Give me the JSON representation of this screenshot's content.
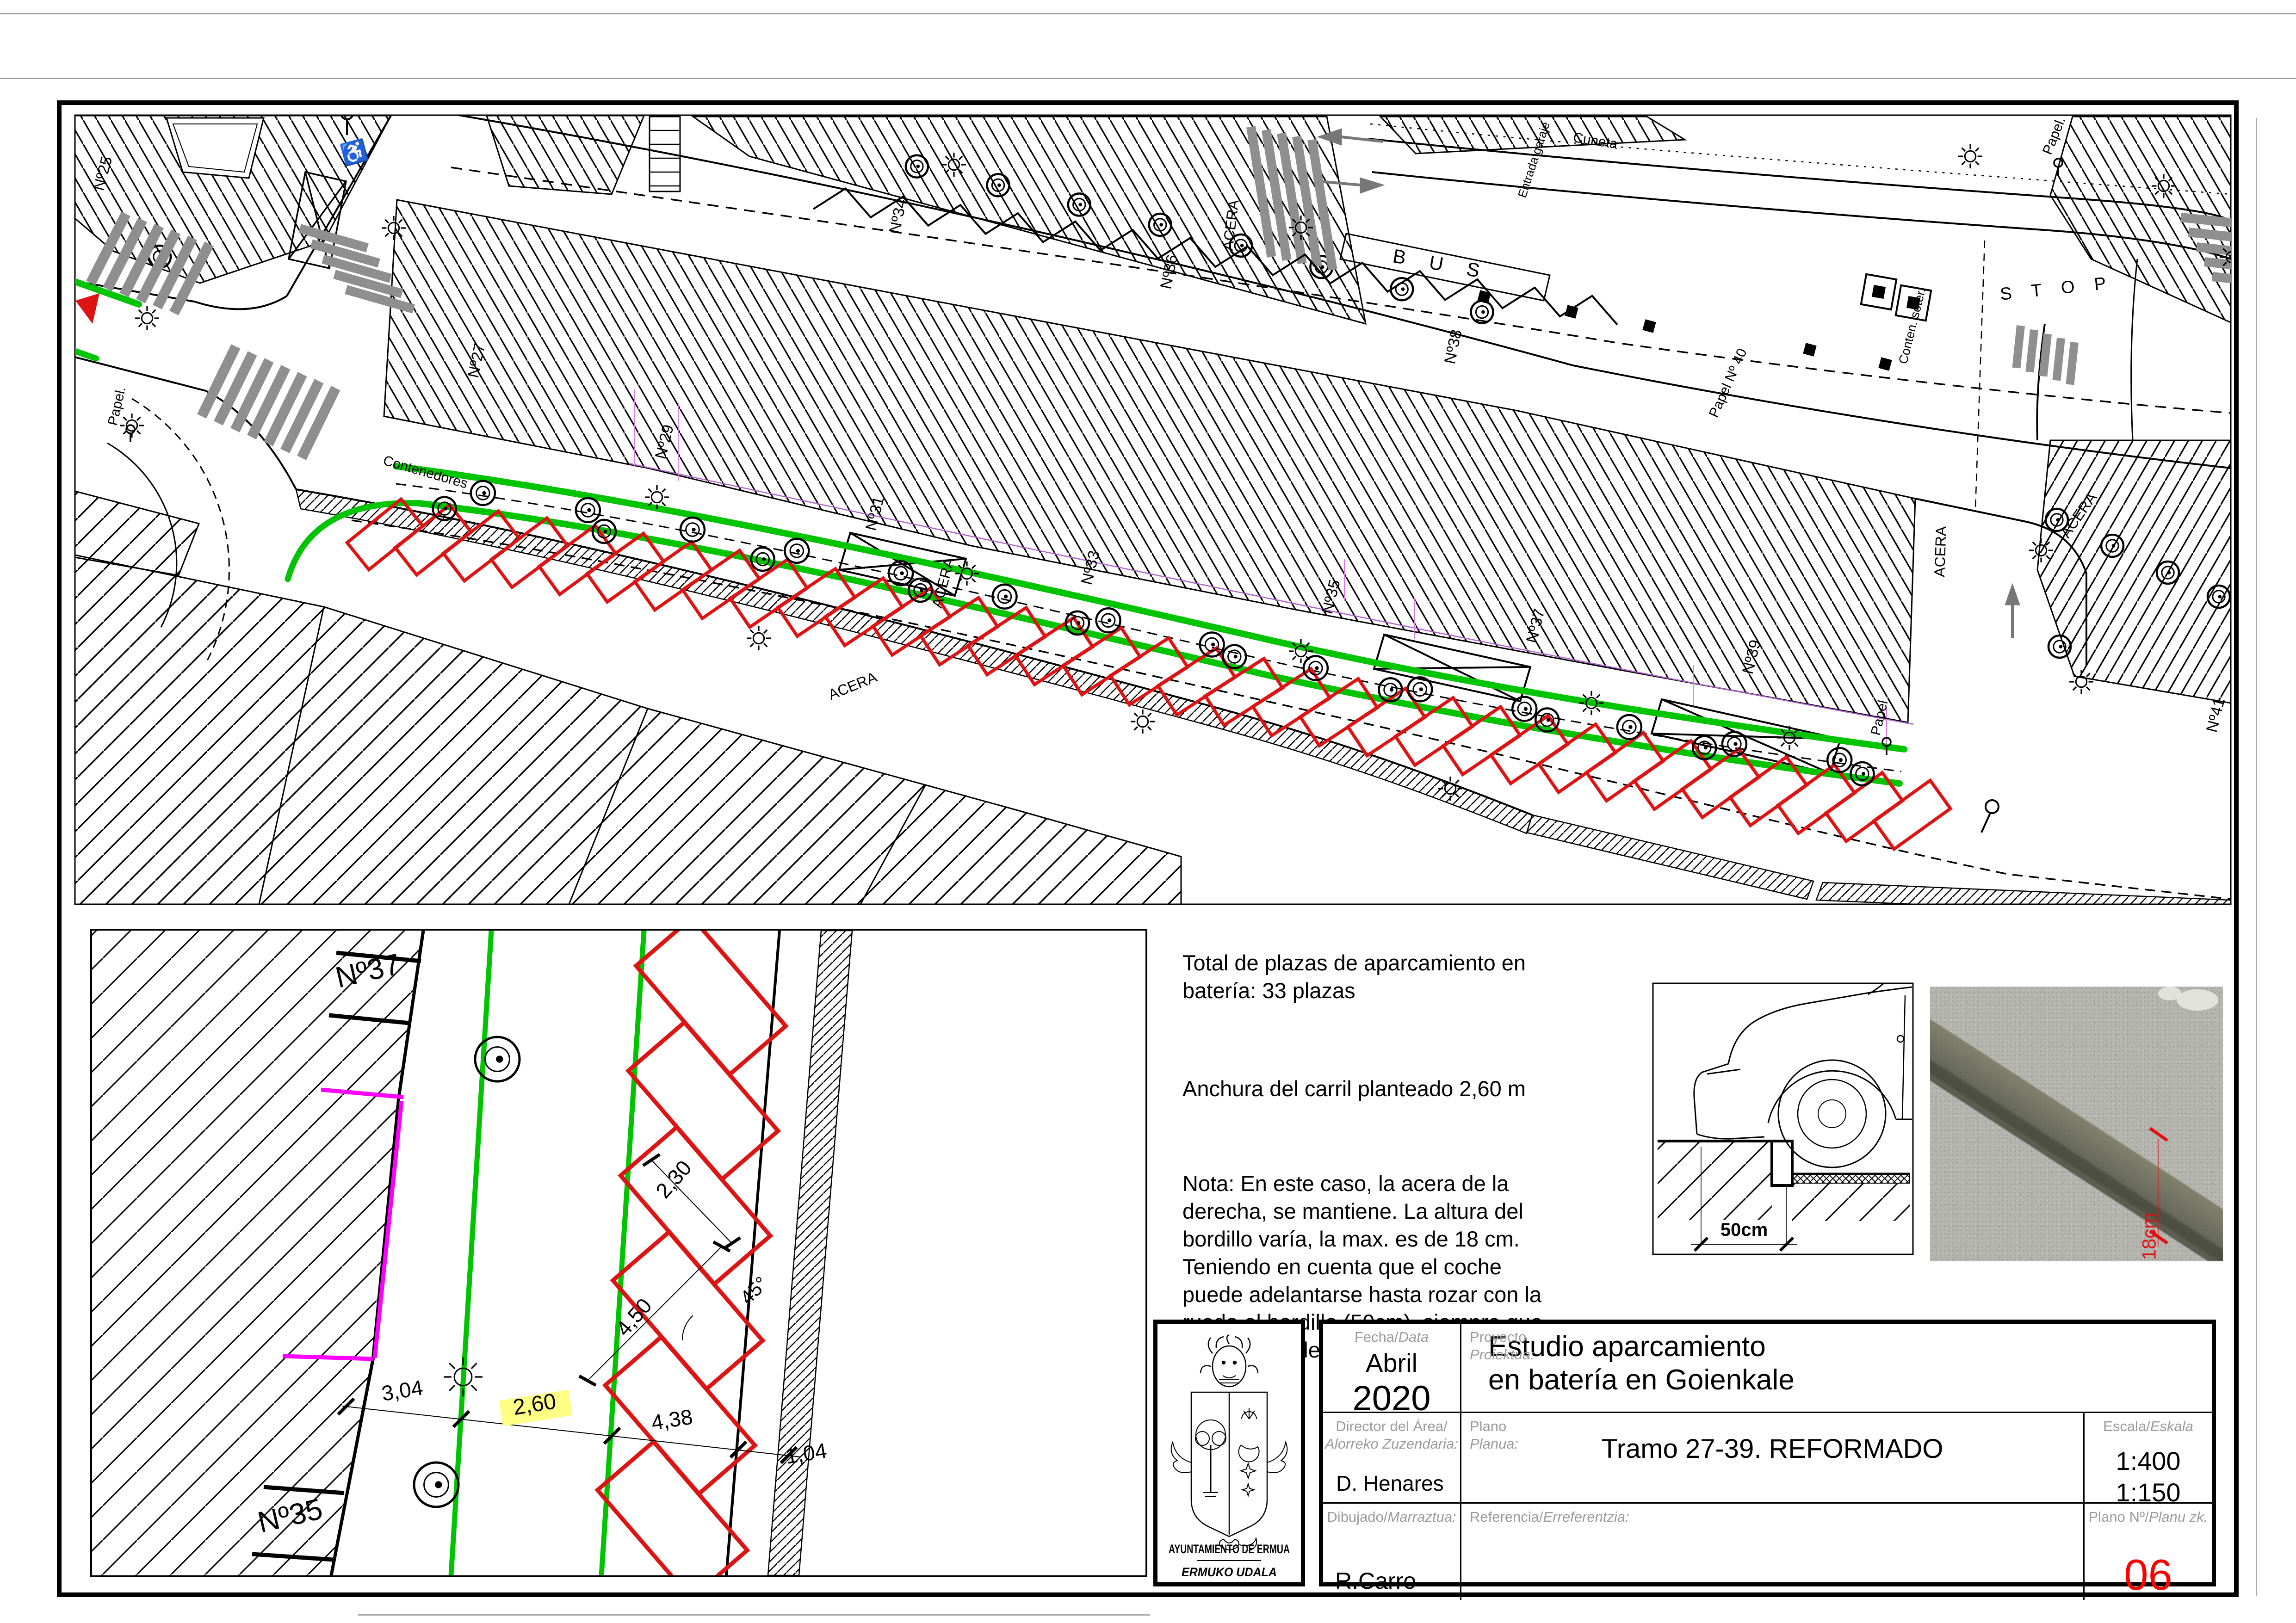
{
  "colors": {
    "green_lane": "#00c400",
    "red_parking": "#dd1414",
    "magenta": "#ff00ff",
    "highlight_yellow": "#ffff85",
    "plan_number_red": "#ff0000",
    "label_gray": "#9a9a9a",
    "zebra_gray": "#8f8f8f"
  },
  "plan": {
    "parking_bays_total": 33,
    "labels": [
      "Nº25",
      "Nº27",
      "Nº29",
      "Nº31",
      "Nº33",
      "Nº35",
      "Nº37",
      "Nº39",
      "Nº41",
      "Nº34",
      "Nº36",
      "Nº38",
      "Papel Nº 40",
      "ACERA",
      "ACERA",
      "ACERA",
      "ACERA",
      "ACERA",
      "Papel.",
      "Papel",
      "Papel.",
      "Contenedores",
      "Conten. soter.",
      "B U S",
      "S T O P",
      "Cuneta",
      "Entrada garaje"
    ]
  },
  "detail": {
    "labels": [
      "Nº37",
      "Nº35",
      "3,04",
      "2,60",
      "4,38",
      "1,04",
      "2,30",
      "4,50",
      "45°"
    ]
  },
  "car_detail": {
    "dimension": "50cm"
  },
  "photo": {
    "dimension": "18cm"
  },
  "notes": {
    "p1": "Total  de plazas de aparcamiento en\nbatería: 33 plazas",
    "p2": "Anchura del carril planteado 2,60 m",
    "p3": "Nota: En este caso, la acera de la\nderecha, se mantiene. La altura del\nbordillo varía, la max. es de 18 cm.\nTeniendo en cuenta que el coche\npuede adelantarse hasta rozar con la\nrueda el bordillo (50cm), siempre que\nde la altura del bordillo lo permita."
  },
  "titleblock": {
    "org_name_es": "AYUNTAMIENTO DE ERMUA",
    "org_name_eu": "ERMUKO UDALA",
    "fecha_label": "Fecha/",
    "fecha_label_eu": "Data",
    "fecha_month": "Abril",
    "fecha_year": "2020",
    "proyecto_label": "Proyecto",
    "proyecto_label_eu": "Proiektua:",
    "proyecto_value": "Estudio aparcamiento\nen batería en Goienkale",
    "director_label": "Director del Área/",
    "director_label_eu": "Alorreko Zuzendaria:",
    "director_value": "D. Henares",
    "plano_label": "Plano",
    "plano_label_eu": "Planua:",
    "plano_value": "Tramo 27-39. REFORMADO",
    "escala_label": "Escala/",
    "escala_label_eu": "Eskala",
    "escala_value": "1:400\n1:150",
    "dibujado_label": "Dibujado/",
    "dibujado_label_eu": "Marraztua:",
    "dibujado_value": "R.Carro",
    "referencia_label": "Referencia/",
    "referencia_label_eu": "Erreferentzia:",
    "referencia_value": "",
    "plano_num_label": "Plano Nº/",
    "plano_num_label_eu": "Planu zk.",
    "plano_num_value": "06"
  }
}
